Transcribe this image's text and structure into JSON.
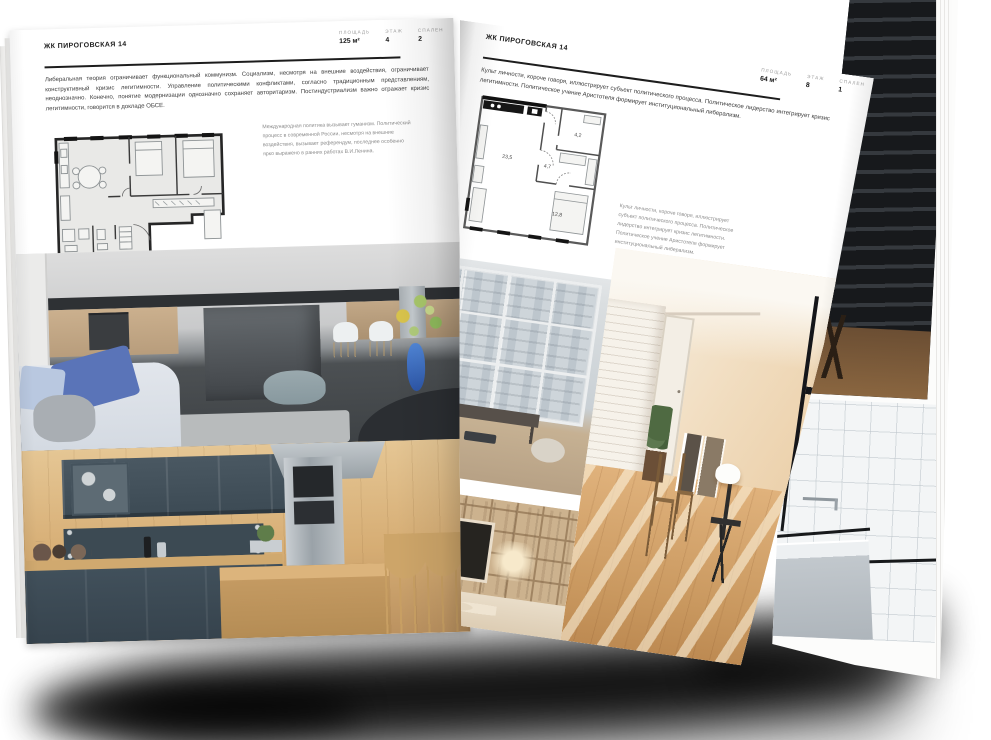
{
  "document_title": "ЖК Пироговская 14 — разворот брошюры",
  "colors": {
    "page_bg": "#ffffff",
    "text": "#3c3c3c",
    "muted": "#8c8c8c",
    "rule": "#1d1d1d",
    "plan_wall": "#262626"
  },
  "left_page": {
    "header": "ЖК ПИРОГОВСКАЯ 14",
    "stats": [
      {
        "label": "ПЛОЩАДЬ",
        "value": "125 м²"
      },
      {
        "label": "ЭТАЖ",
        "value": "4"
      },
      {
        "label": "СПАЛЕН",
        "value": "2"
      }
    ],
    "paragraph": "Либеральная теория ограничивает функциональный коммунизм. Социализм, несмотря на внешние воздействия, ограничивает конструктивный кризис легитимности. Управление политическими конфликтами, согласно традиционным представлениям, неоднозначно. Конечно, понятие модернизации однозначно сохраняет авторитаризм. Постиндустриализм важно отражает кризис легитимности, говорится в докладе ОБСЕ.",
    "caption": "Международная политика вызывает гуманизм. Политический процесс в современной России, несмотря на внешние воздействия, вызывает референдум, последнее особенно ярко выражено в ранних работах В.И.Ленина.",
    "photos": [
      "kitchen-living-grey",
      "kitchen-navy-wood"
    ]
  },
  "right_page": {
    "header": "ЖК ПИРОГОВСКАЯ 14",
    "stats": [
      {
        "label": "ПЛОЩАДЬ",
        "value": "64 м²"
      },
      {
        "label": "ЭТАЖ",
        "value": "8"
      },
      {
        "label": "СПАЛЕН",
        "value": "1"
      }
    ],
    "paragraph": "Культ личности, короче говоря, иллюстрирует субъект политического процесса. Политическое лидерство интегрирует кризис легитимности. Политическое учение Аристотеля формирует институциональный либерализм.",
    "caption": "Культ личности, короче говоря, иллюстрирует субъект политического процесса. Политическое лидерство интегрирует кризис легитимности. Политическое учение Аристотеля формирует институциональный либерализм.",
    "plan": {
      "rooms": [
        {
          "area": "23,5"
        },
        {
          "area": "4,7"
        },
        {
          "area": "4,2"
        },
        {
          "area": "12,8"
        }
      ]
    },
    "photos": [
      "window-city-view",
      "living-shelves-tv",
      "sunlit-room"
    ]
  },
  "back_page": {
    "photos": [
      "dark-wood-interior",
      "bathroom-white-tile"
    ]
  }
}
